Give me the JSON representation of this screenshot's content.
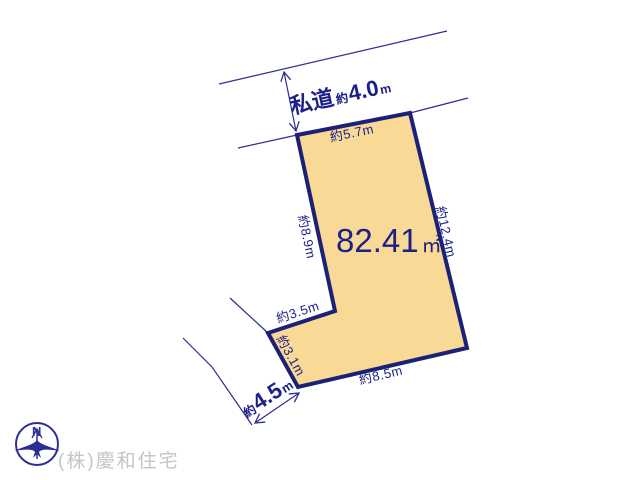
{
  "diagram": {
    "plot": {
      "area": {
        "value": "82.41",
        "unit": "㎡"
      },
      "edge_labels": {
        "top": "約5.7m",
        "left": "約8.9m",
        "right": "約12.4m",
        "notch_top": "約3.5m",
        "notch_side": "約3.1m",
        "bottom": "約8.5m"
      },
      "fill_color": "#F8D995",
      "border_color": "#1C2178"
    },
    "private_road": {
      "name": "私道",
      "approx": "約",
      "width": "4.0",
      "unit": "m"
    },
    "side_road": {
      "approx": "約",
      "width": "4.5",
      "unit": "m"
    },
    "line_color": "#2B2F94",
    "text_color": "#1D2086"
  },
  "compass": {
    "north_label": "N"
  },
  "footer": {
    "company": "(株)慶和住宅",
    "color": "#C5C5C5"
  }
}
